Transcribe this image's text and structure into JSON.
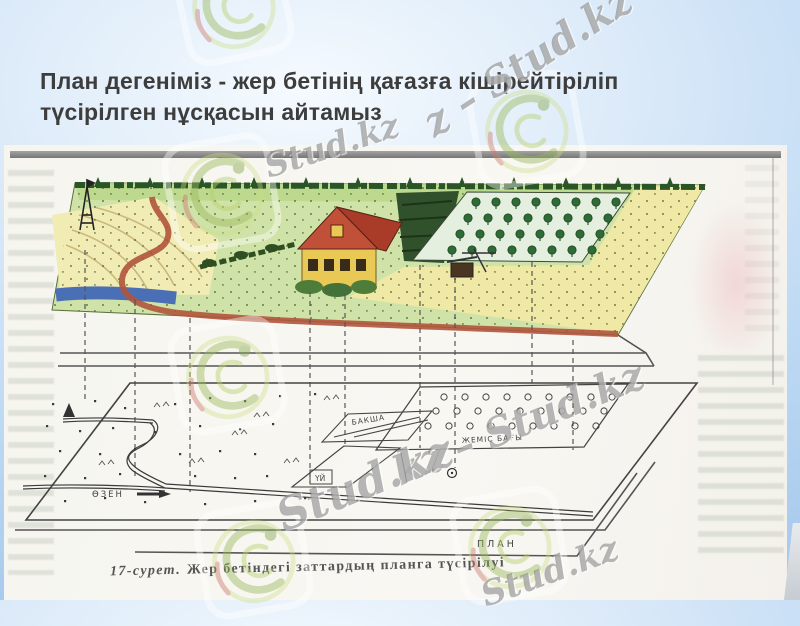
{
  "slide": {
    "title_line1": "План дегеніміз - жер бетінің қағазға кішірейтіріліп",
    "title_line2": "түсірілген нұсқасын айтамыз"
  },
  "figure": {
    "caption_number": "17-сурет.",
    "caption_text": "Жер бетіндегі заттардың планга түсірілуі",
    "plan_labels": {
      "river": "ӨЗЕН",
      "garden": "БАКША",
      "house": "ҮЙ",
      "orchard": "ЖЕМІС БАҒЫ",
      "plan": "ПЛАН"
    }
  },
  "watermarks": {
    "brand": "Stud.kz",
    "texts": [
      "z – Stud.kz",
      "Stud.kz",
      "kz – Stud.kz",
      "Stud.kz",
      "Stud.kz"
    ]
  },
  "colors": {
    "background_blue": "#a5c8ec",
    "title_text": "#3d3d3d",
    "grass_green": "#cfe3a8",
    "field_yellow": "#f0e9a6",
    "river_blue": "#4a6fb5",
    "road_red": "#b0543c",
    "roof_red": "#a83c28",
    "ink_gray": "#444444",
    "watermark_gray": "#787878"
  }
}
